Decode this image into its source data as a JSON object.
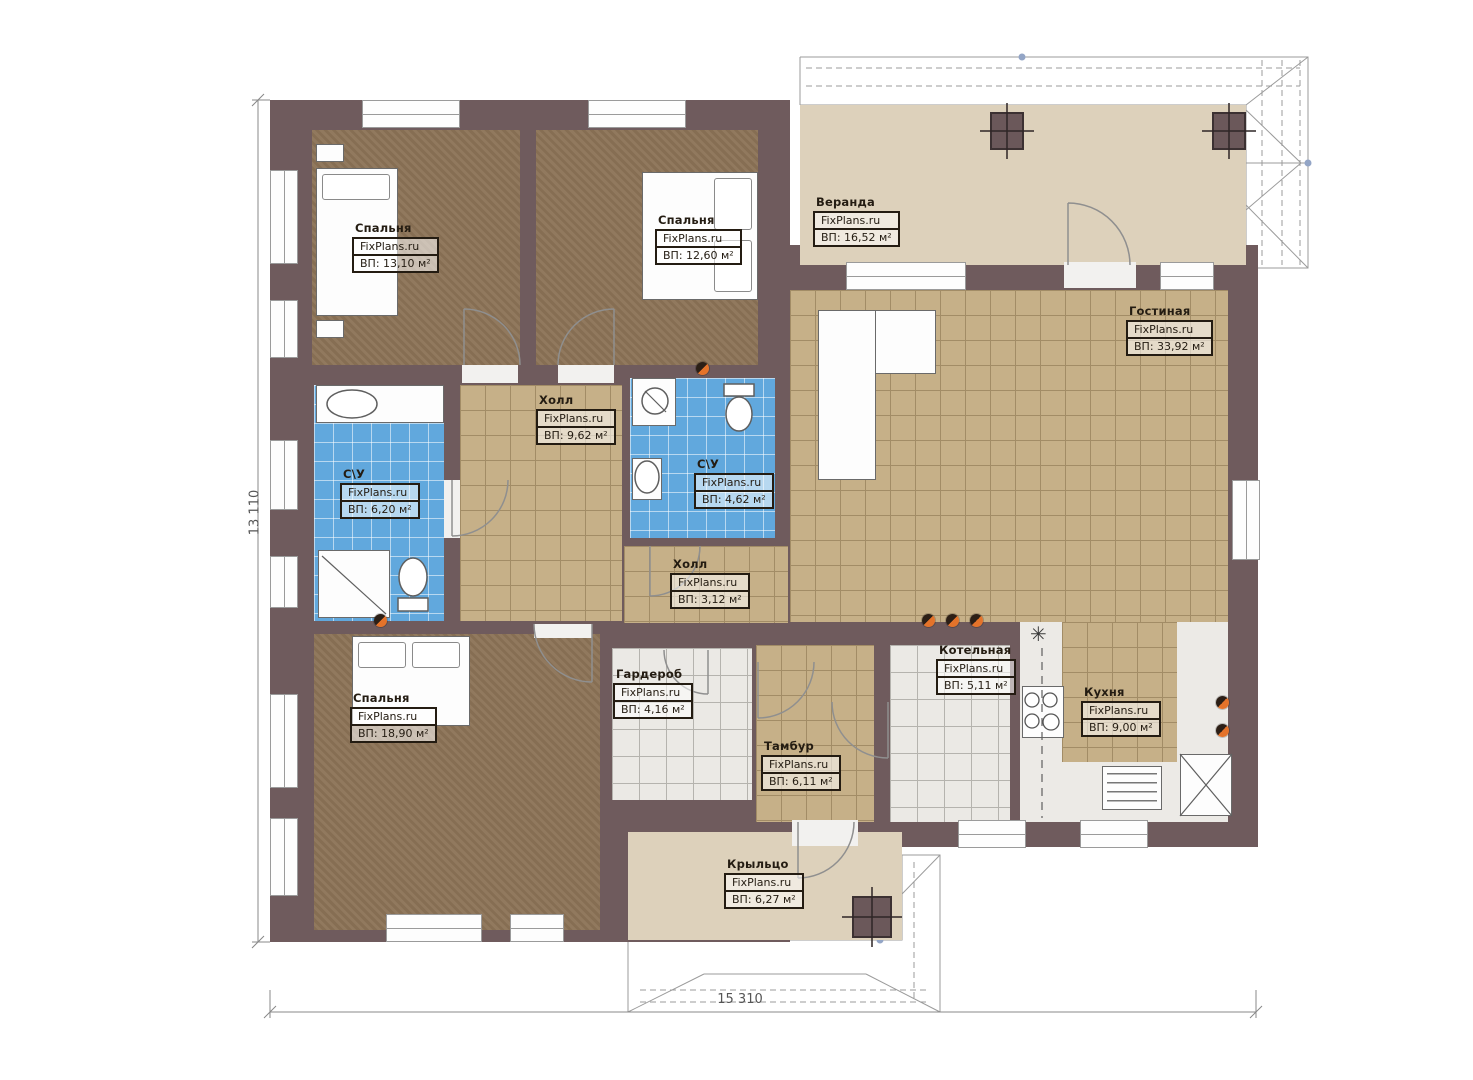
{
  "plan": {
    "site_label": "FixPlans.ru",
    "dimensions": {
      "height_left": "13 110",
      "width_bottom": "15 310"
    },
    "icons": {
      "lamp": "✳"
    },
    "colors": {
      "wall": "#6f5b5d",
      "tile_tan": "#c6b088",
      "tile_blue": "#61a8dd",
      "tile_white": "#ebe9e5",
      "carpet": "#8d7457",
      "deck": "#ddd1bb",
      "vent_orange": "#e4732a"
    },
    "rooms": [
      {
        "id": "bedroom-1",
        "name": "Спальня",
        "area": "ВП: 13,10 м²"
      },
      {
        "id": "bedroom-2",
        "name": "Спальня",
        "area": "ВП: 12,60 м²"
      },
      {
        "id": "veranda",
        "name": "Веранда",
        "area": "ВП: 16,52 м²"
      },
      {
        "id": "living-room",
        "name": "Гостиная",
        "area": "ВП: 33,92 м²"
      },
      {
        "id": "hall",
        "name": "Холл",
        "area": "ВП: 9,62 м²"
      },
      {
        "id": "bathroom-1",
        "name": "С\\У",
        "area": "ВП: 6,20 м²"
      },
      {
        "id": "bathroom-2",
        "name": "С\\У",
        "area": "ВП: 4,62 м²"
      },
      {
        "id": "hall-2",
        "name": "Холл",
        "area": "ВП: 3,12 м²"
      },
      {
        "id": "bedroom-3",
        "name": "Спальня",
        "area": "ВП: 18,90 м²"
      },
      {
        "id": "wardrobe",
        "name": "Гардероб",
        "area": "ВП: 4,16 м²"
      },
      {
        "id": "tambour",
        "name": "Тамбур",
        "area": "ВП: 6,11 м²"
      },
      {
        "id": "boiler-room",
        "name": "Котельная",
        "area": "ВП: 5,11 м²"
      },
      {
        "id": "kitchen",
        "name": "Кухня",
        "area": "ВП: 9,00 м²"
      },
      {
        "id": "porch",
        "name": "Крыльцо",
        "area": "ВП: 6,27 м²"
      }
    ]
  }
}
